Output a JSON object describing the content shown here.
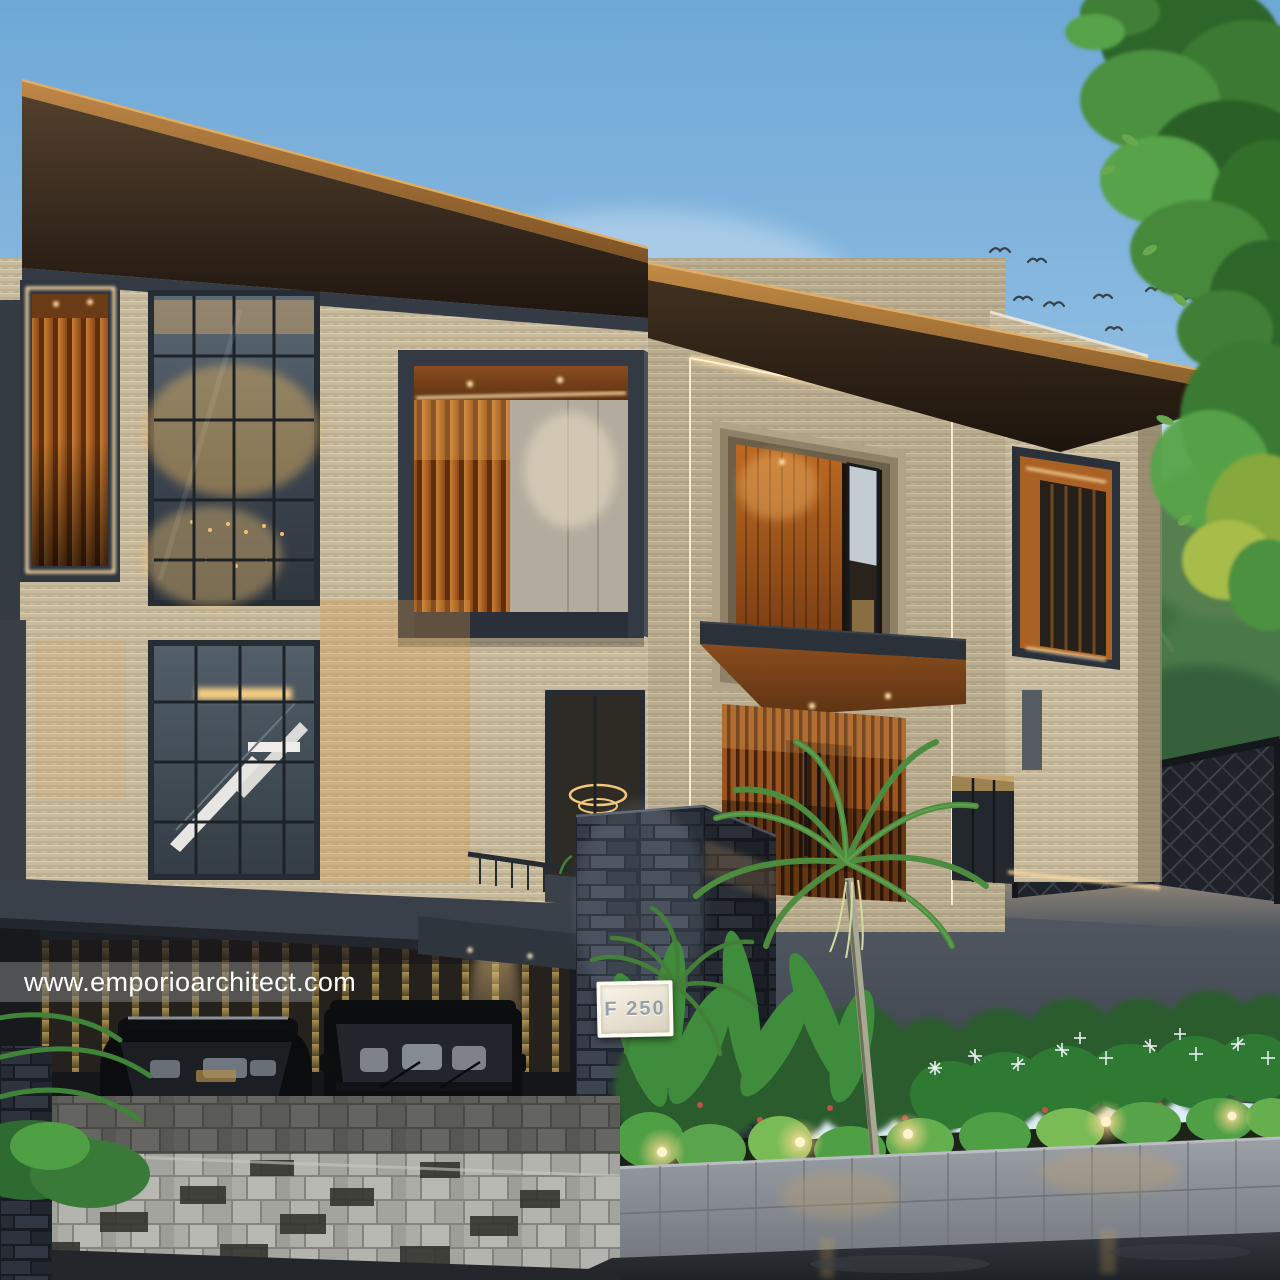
{
  "scene": {
    "kind": "architectural-exterior-render",
    "time_of_day": "dusk",
    "watermark": {
      "text": "www.emporioarchitect.com"
    },
    "plaque": {
      "text": "F 250"
    },
    "palette": {
      "sky_top": "#6ea8d6",
      "sky_horizon": "#e9f2f8",
      "roof_wood": "#b5803e",
      "roof_soffit": "#2a1d13",
      "travertine": "#c7ba9d",
      "charcoal_frame": "#343b44",
      "wood_louver": "#b05f1e",
      "led_warm": "#ffdfa3",
      "glass": "#46525e",
      "basalt_stone": "#363e4a",
      "perimeter_wall": "#4b525b",
      "foliage_green": "#3f8d3c",
      "car_black": "#0c0d0f",
      "chrome": "#c9ced3",
      "paver_light": "#adada8",
      "asphalt": "#272a2f"
    }
  }
}
